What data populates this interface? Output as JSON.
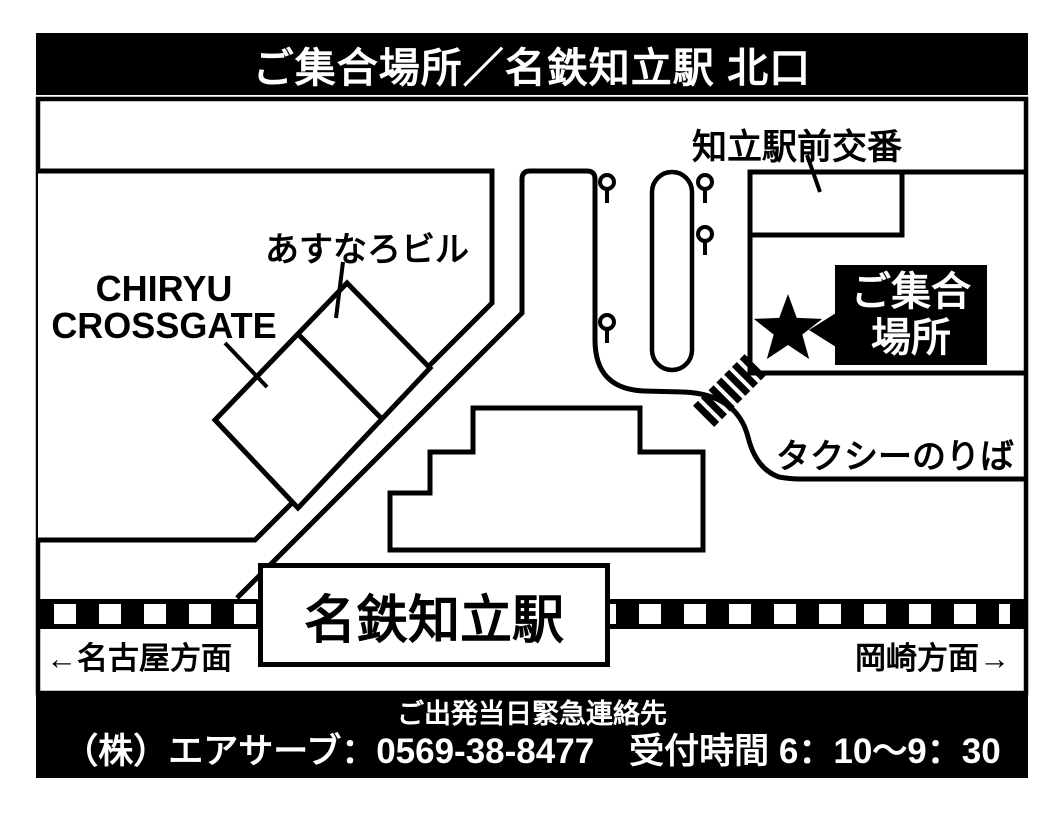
{
  "colors": {
    "ink": "#000000",
    "paper": "#ffffff"
  },
  "header": {
    "title": "ご集合場所／名鉄知立駅 北口"
  },
  "map": {
    "blocks": {
      "crossgate_label_line1": "CHIRYU",
      "crossgate_label_line2": "CROSSGATE",
      "asunaro_label": "あすなろビル",
      "koban_label": "知立駅前交番",
      "station_label": "名鉄知立駅",
      "taxi_label": "タクシーのりば"
    },
    "meeting_point": {
      "marker_icon": "star",
      "line1": "ご集合",
      "line2": "場所"
    },
    "directions": {
      "west": "←名古屋方面",
      "east": "岡崎方面→"
    }
  },
  "footer": {
    "line1": "ご出発当日緊急連絡先",
    "line2": "（株）エアサーブ：0569-38-8477　受付時間 6：10～9：30"
  }
}
